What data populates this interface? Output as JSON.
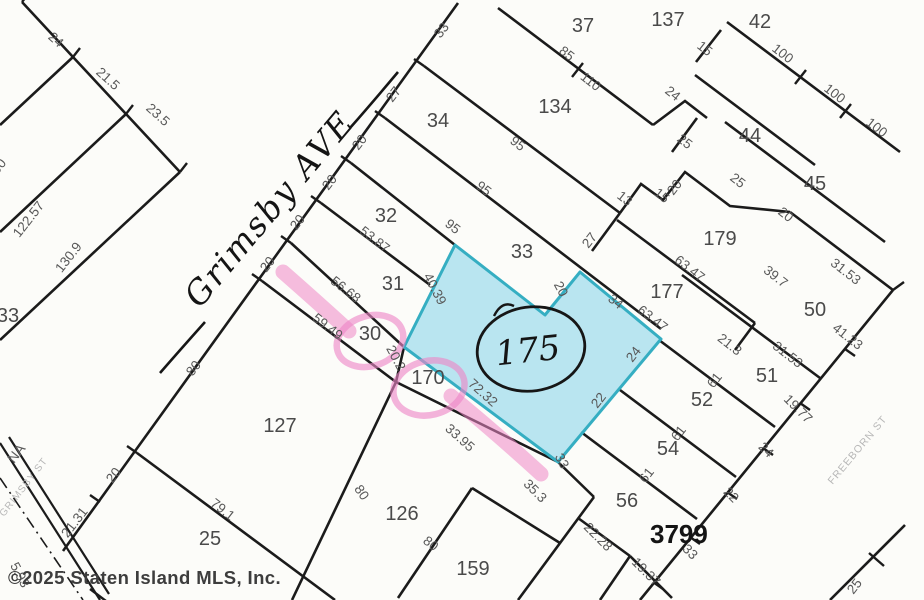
{
  "map": {
    "type": "tax-plat-map",
    "block_number": "3799",
    "highlighted_lot_number": "175",
    "handwritten_street": "Grimsby AVE",
    "gray_street_labels": {
      "grimsby_st": "GRIMSBY ST",
      "freeborn_st": "FREEBORN ST",
      "na_fragment": "NA"
    },
    "copyright": "©2025 Staten Island MLS, Inc.",
    "colors": {
      "line-color": "#1b1b1b",
      "lot-label-color": "#4a4a4a",
      "dim-label-color": "#585858",
      "street-gray-color": "#b7b7b7",
      "copyright-color": "#3d3d3d",
      "highlight-blue": "#9fdcec",
      "highlight-blue-border": "#35aec2",
      "highlight-pink": "#ee86c7"
    },
    "lot_labels": [
      {
        "text": "37",
        "x": 583,
        "y": 32
      },
      {
        "text": "137",
        "x": 668,
        "y": 26
      },
      {
        "text": "42",
        "x": 760,
        "y": 28
      },
      {
        "text": "134",
        "x": 555,
        "y": 113
      },
      {
        "text": "34",
        "x": 438,
        "y": 127
      },
      {
        "text": "44",
        "x": 750,
        "y": 142
      },
      {
        "text": "45",
        "x": 815,
        "y": 190
      },
      {
        "text": "32",
        "x": 386,
        "y": 222
      },
      {
        "text": "179",
        "x": 720,
        "y": 245
      },
      {
        "text": "33",
        "x": 522,
        "y": 258
      },
      {
        "text": "31",
        "x": 393,
        "y": 290
      },
      {
        "text": "177",
        "x": 667,
        "y": 298
      },
      {
        "text": "50",
        "x": 815,
        "y": 316
      },
      {
        "text": "30",
        "x": 370,
        "y": 340
      },
      {
        "text": "51",
        "x": 767,
        "y": 382
      },
      {
        "text": "170",
        "x": 428,
        "y": 384
      },
      {
        "text": "52",
        "x": 702,
        "y": 406
      },
      {
        "text": "127",
        "x": 280,
        "y": 432
      },
      {
        "text": "54",
        "x": 668,
        "y": 455
      },
      {
        "text": "56",
        "x": 627,
        "y": 507
      },
      {
        "text": "126",
        "x": 402,
        "y": 520
      },
      {
        "text": "25",
        "x": 210,
        "y": 545
      },
      {
        "text": "159",
        "x": 473,
        "y": 575
      },
      {
        "text": "33",
        "x": 8,
        "y": 322
      }
    ],
    "dimension_labels": [
      {
        "text": "24",
        "x": 53,
        "y": 43,
        "rot": 42
      },
      {
        "text": "21.5",
        "x": 105,
        "y": 82,
        "rot": 42
      },
      {
        "text": "23.5",
        "x": 155,
        "y": 118,
        "rot": 42
      },
      {
        "text": "100",
        "x": 0,
        "y": 172,
        "rot": -52
      },
      {
        "text": "122.57",
        "x": 32,
        "y": 222,
        "rot": -52
      },
      {
        "text": "130.9",
        "x": 72,
        "y": 260,
        "rot": -52
      },
      {
        "text": "33",
        "x": 445,
        "y": 33,
        "rot": -52
      },
      {
        "text": "27",
        "x": 397,
        "y": 97,
        "rot": -52
      },
      {
        "text": "20",
        "x": 363,
        "y": 145,
        "rot": -52
      },
      {
        "text": "20",
        "x": 333,
        "y": 185,
        "rot": -52
      },
      {
        "text": "20",
        "x": 301,
        "y": 225,
        "rot": -52
      },
      {
        "text": "20",
        "x": 271,
        "y": 267,
        "rot": -52
      },
      {
        "text": "80",
        "x": 197,
        "y": 371,
        "rot": -52
      },
      {
        "text": "20",
        "x": 117,
        "y": 478,
        "rot": -52
      },
      {
        "text": "21.31",
        "x": 78,
        "y": 525,
        "rot": -52
      },
      {
        "text": "5.93",
        "x": 16,
        "y": 577,
        "rot": 62
      },
      {
        "text": "53.87",
        "x": 372,
        "y": 243,
        "rot": 38
      },
      {
        "text": "56.68",
        "x": 343,
        "y": 293,
        "rot": 38
      },
      {
        "text": "59.49",
        "x": 325,
        "y": 330,
        "rot": 38
      },
      {
        "text": "95",
        "x": 515,
        "y": 147,
        "rot": 38
      },
      {
        "text": "95",
        "x": 481,
        "y": 192,
        "rot": 38
      },
      {
        "text": "95",
        "x": 450,
        "y": 230,
        "rot": 38
      },
      {
        "text": "85",
        "x": 564,
        "y": 57,
        "rot": 38
      },
      {
        "text": "110",
        "x": 588,
        "y": 85,
        "rot": 38
      },
      {
        "text": "27",
        "x": 593,
        "y": 243,
        "rot": -52
      },
      {
        "text": "13",
        "x": 622,
        "y": 202,
        "rot": 38
      },
      {
        "text": "15",
        "x": 659,
        "y": 199,
        "rot": 38
      },
      {
        "text": "15",
        "x": 702,
        "y": 52,
        "rot": 38
      },
      {
        "text": "24",
        "x": 670,
        "y": 97,
        "rot": 38
      },
      {
        "text": "25",
        "x": 682,
        "y": 145,
        "rot": 38
      },
      {
        "text": "20",
        "x": 678,
        "y": 190,
        "rot": -52
      },
      {
        "text": "100",
        "x": 780,
        "y": 57,
        "rot": 38
      },
      {
        "text": "100",
        "x": 832,
        "y": 97,
        "rot": 38
      },
      {
        "text": "100",
        "x": 874,
        "y": 131,
        "rot": 38
      },
      {
        "text": "25",
        "x": 735,
        "y": 184,
        "rot": 38
      },
      {
        "text": "20",
        "x": 783,
        "y": 218,
        "rot": 38
      },
      {
        "text": "63.47",
        "x": 687,
        "y": 272,
        "rot": 38
      },
      {
        "text": "39.7",
        "x": 773,
        "y": 280,
        "rot": 38
      },
      {
        "text": "31.53",
        "x": 843,
        "y": 275,
        "rot": 38
      },
      {
        "text": "41.23",
        "x": 845,
        "y": 340,
        "rot": 38
      },
      {
        "text": "31.53",
        "x": 785,
        "y": 358,
        "rot": 38
      },
      {
        "text": "21.3",
        "x": 727,
        "y": 348,
        "rot": 38
      },
      {
        "text": "63.47",
        "x": 650,
        "y": 322,
        "rot": 38
      },
      {
        "text": "34",
        "x": 613,
        "y": 305,
        "rot": 38
      },
      {
        "text": "20",
        "x": 557,
        "y": 291,
        "rot": 62
      },
      {
        "text": "40.39",
        "x": 431,
        "y": 291,
        "rot": 62
      },
      {
        "text": "20.2",
        "x": 392,
        "y": 360,
        "rot": 62
      },
      {
        "text": "24",
        "x": 637,
        "y": 357,
        "rot": -52
      },
      {
        "text": "22",
        "x": 602,
        "y": 403,
        "rot": -52
      },
      {
        "text": "33",
        "x": 558,
        "y": 463,
        "rot": 62
      },
      {
        "text": "72.32",
        "x": 480,
        "y": 396,
        "rot": 42
      },
      {
        "text": "33.95",
        "x": 457,
        "y": 441,
        "rot": 42
      },
      {
        "text": "35.3",
        "x": 532,
        "y": 494,
        "rot": 45
      },
      {
        "text": "61",
        "x": 718,
        "y": 383,
        "rot": -52
      },
      {
        "text": "61",
        "x": 682,
        "y": 436,
        "rot": -52
      },
      {
        "text": "61",
        "x": 650,
        "y": 478,
        "rot": -52
      },
      {
        "text": "19.77",
        "x": 795,
        "y": 412,
        "rot": 45
      },
      {
        "text": "24",
        "x": 763,
        "y": 453,
        "rot": 45
      },
      {
        "text": "22",
        "x": 728,
        "y": 498,
        "rot": 45
      },
      {
        "text": "33",
        "x": 687,
        "y": 555,
        "rot": 45
      },
      {
        "text": "19.37",
        "x": 643,
        "y": 575,
        "rot": 45
      },
      {
        "text": "22.28",
        "x": 595,
        "y": 540,
        "rot": 45
      },
      {
        "text": "80",
        "x": 428,
        "y": 547,
        "rot": 38
      },
      {
        "text": "80",
        "x": 358,
        "y": 495,
        "rot": 55
      },
      {
        "text": "79.1",
        "x": 220,
        "y": 513,
        "rot": 38
      },
      {
        "text": "25",
        "x": 858,
        "y": 589,
        "rot": -52
      }
    ]
  }
}
